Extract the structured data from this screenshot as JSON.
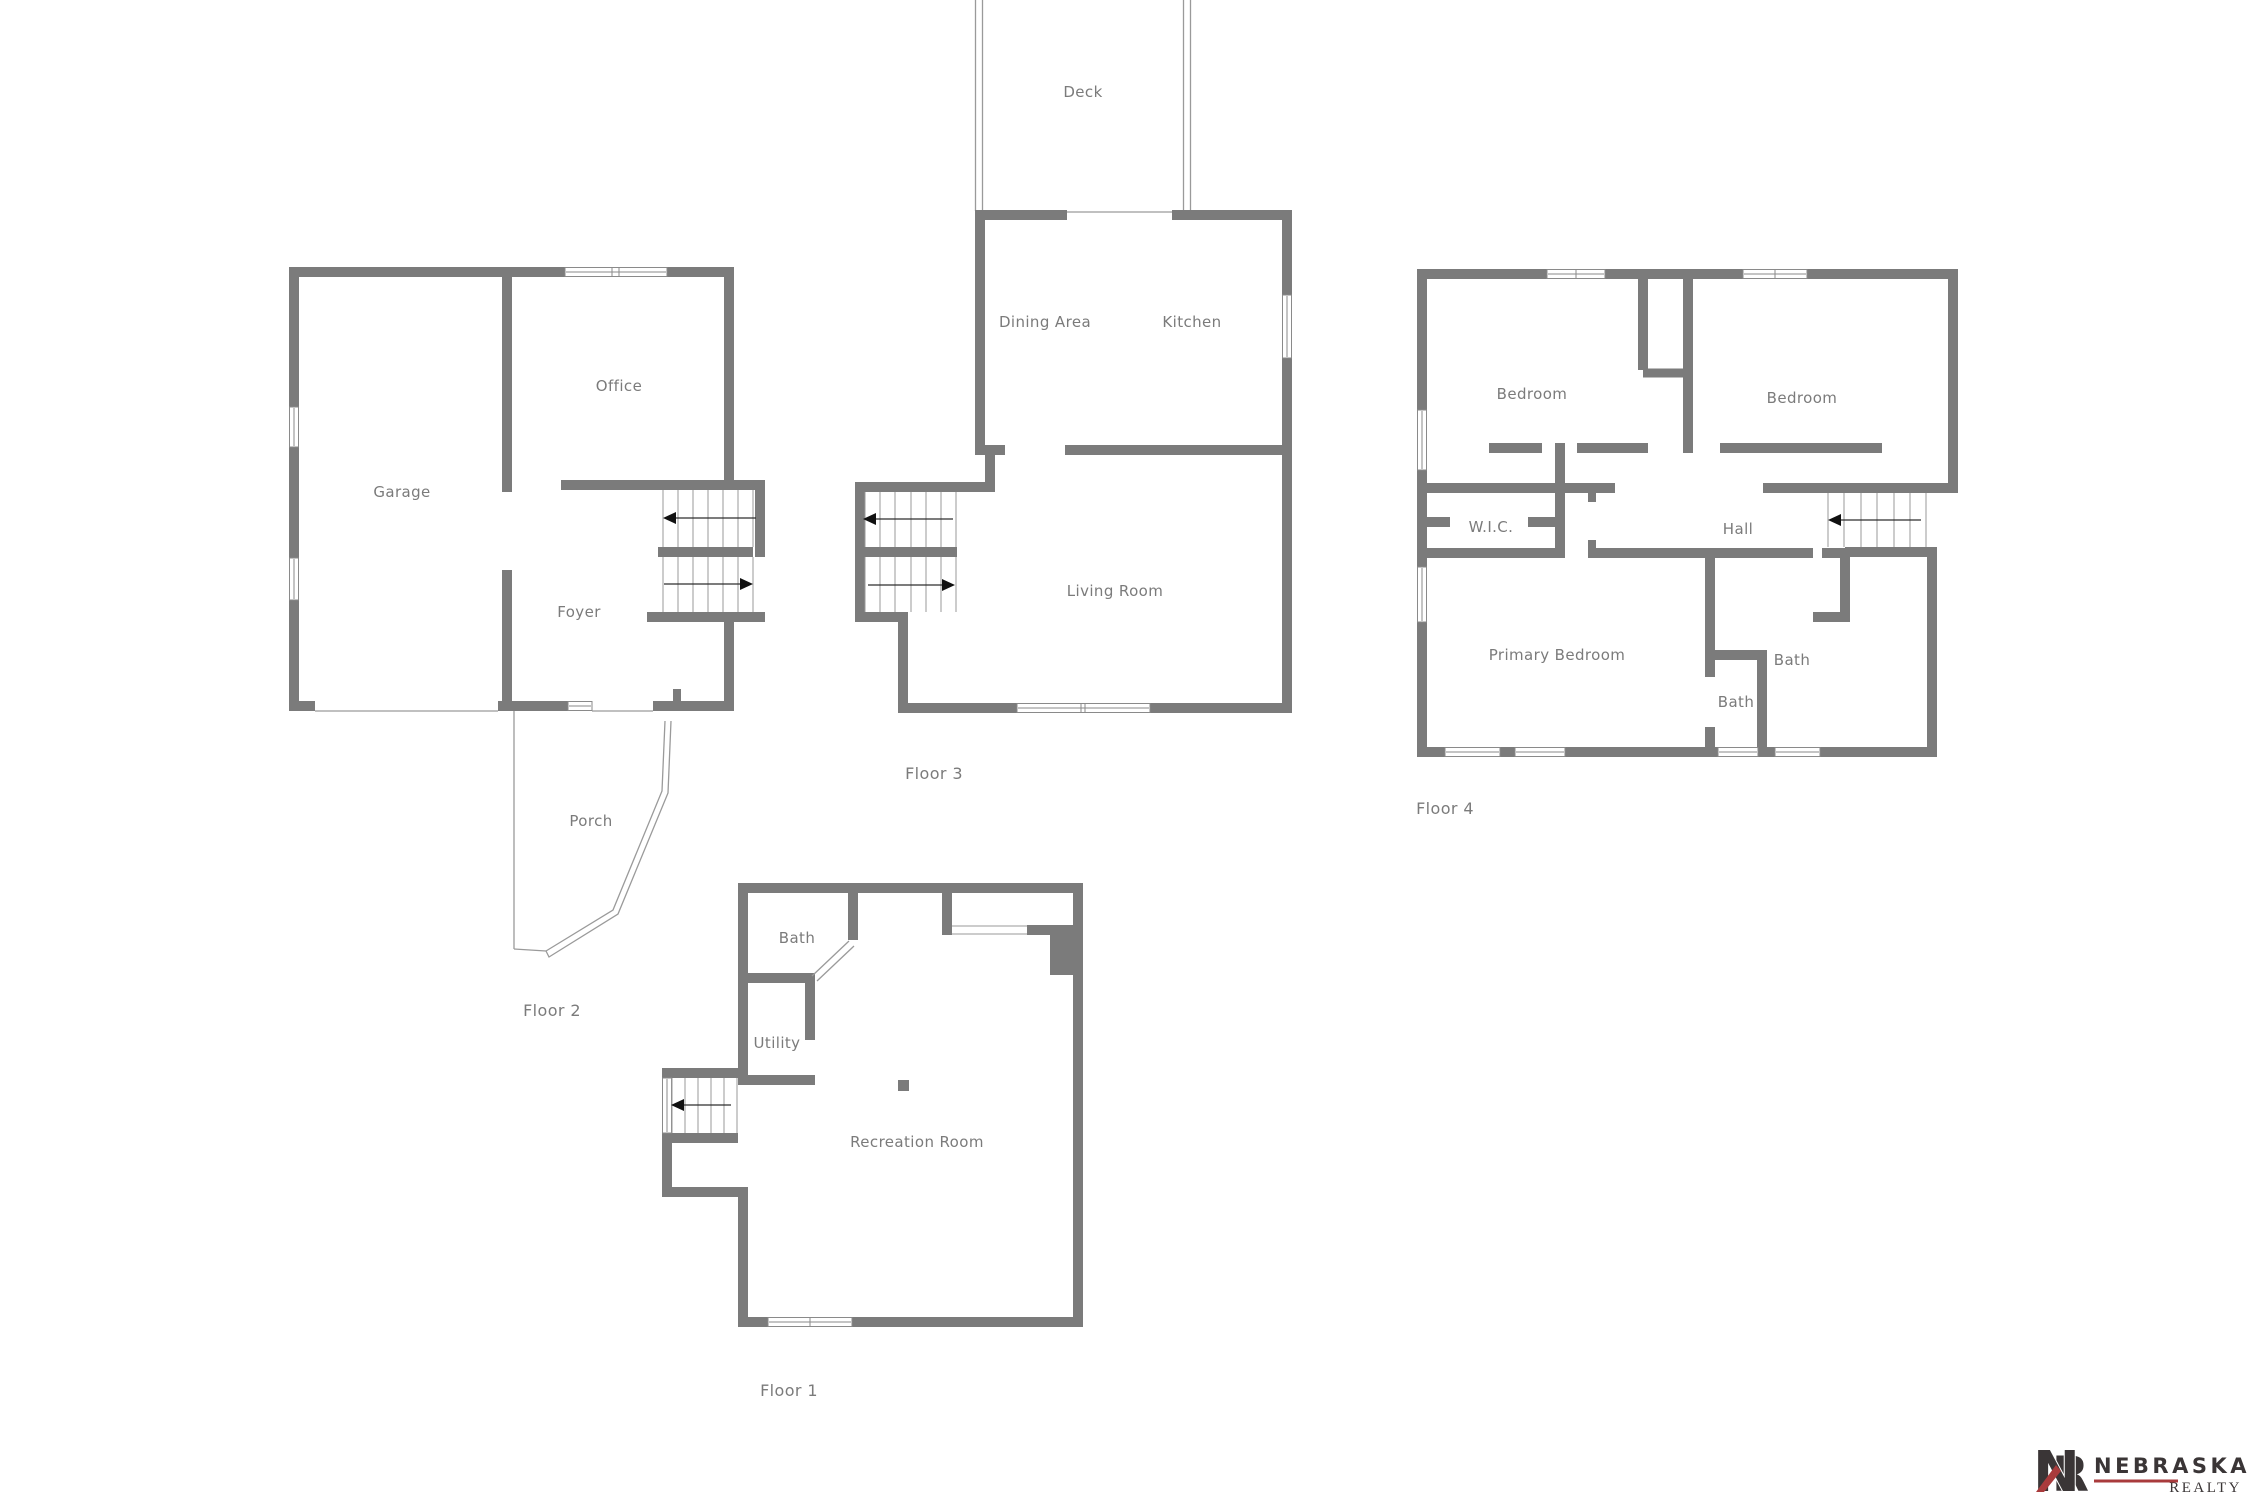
{
  "floors": {
    "floor2": {
      "caption": "Floor 2",
      "garage": "Garage",
      "office": "Office",
      "foyer": "Foyer",
      "porch": "Porch"
    },
    "floor3": {
      "caption": "Floor 3",
      "deck": "Deck",
      "dining": "Dining Area",
      "kitchen": "Kitchen",
      "living": "Living Room"
    },
    "floor4": {
      "caption": "Floor 4",
      "bedroom1": "Bedroom",
      "bedroom2": "Bedroom",
      "wic": "W.I.C.",
      "hall": "Hall",
      "primary": "Primary Bedroom",
      "bath1": "Bath",
      "bath2": "Bath"
    },
    "floor1": {
      "caption": "Floor 1",
      "bath": "Bath",
      "utility": "Utility",
      "recreation": "Recreation Room"
    }
  },
  "logo": {
    "monogram_n": "N",
    "monogram_r": "R",
    "name": "NEBRASKA",
    "division": "REALTY"
  },
  "colors": {
    "wall": "#7b7b7b",
    "label": "#7b7b7b",
    "thin_line": "#9a9a9a",
    "arrow": "#111111",
    "logo_dark": "#3a3536",
    "logo_red": "#a93b3c",
    "background": "#ffffff"
  }
}
